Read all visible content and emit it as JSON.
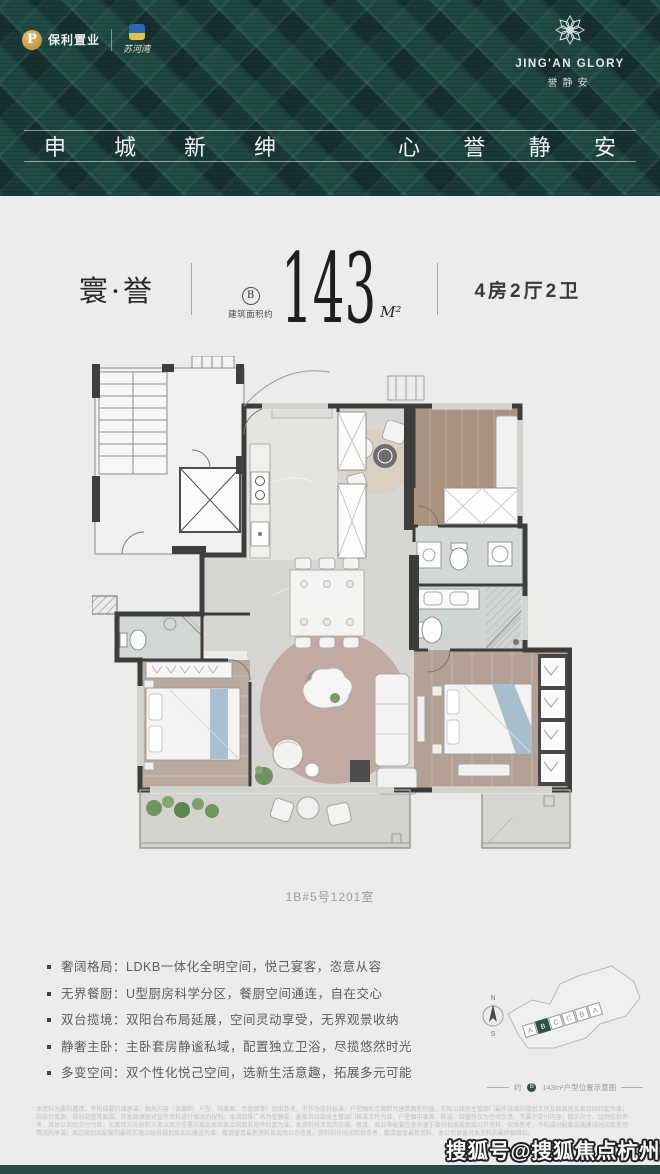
{
  "header": {
    "logo_poly": "保利置业",
    "logo_partner": "苏河湾",
    "brand_en": "JING'AN GLORY",
    "brand_cn": "誉静安",
    "slogan": [
      "申",
      "城",
      "新",
      "绅",
      "心",
      "誉",
      "静",
      "安"
    ]
  },
  "unit": {
    "series": "寰·誉",
    "type_circle": "B",
    "area_prefix": "建筑面积约",
    "area": "143",
    "area_unit": "M²",
    "layout": "4房2厅2卫",
    "room_no": "1B#5号1201室"
  },
  "features": [
    "奢阔格局：LDKB一体化全明空间，悦己宴客，恣意从容",
    "无界餐厨：U型厨房科学分区，餐厨空间通连，自在交心",
    "双台揽境：双阳台布局延展，空间灵动享受，无界观景收纳",
    "静奢主卧：主卧套房静谧私域，配置独立卫浴，尽揽悠然时光",
    "多变空间：双个性化悦己空间，选新生活意趣，拓展多元可能"
  ],
  "siteplan": {
    "compass_n": "N",
    "compass_s": "S",
    "units": [
      "A",
      "B",
      "C",
      "C",
      "B",
      "A"
    ],
    "highlight_fill": "#2f4f48",
    "caption_prefix": "约",
    "caption_circle": "B",
    "caption_text": "143m²户型位置示意图"
  },
  "disclaimer": [
    "本资料为要约邀请，不构成要约或承诺，相关内容（含面积、户型、效果图、示意图等）仅供参考，不作为交付标准；户型图所示面积为建筑面积约值，实际以政府主管部门最终核准的规划文件及商品房买卖合同约定为准；因设计变更、规划调整等原因，开发商保留对宣传资料进行修改的权利。",
    "本项目推广名为誉静安，备案名以政府主管部门核准文件为准；户型图中家具、陈设、绿植等仅为空间示意，不属于交付内容；图示尺寸、比例仅供参考，具体以实际交付为准；买卖双方的权利义务以双方签署的商品房买卖合同及其附件约定为准。",
    "本资料所涉及的交通、教育、商业等配套信息来源于政府相关规划或公开资料，仅供参考，不构成对配套设施建成时间及使用情况的承诺；周边规划及配套的最终实施以政府规划及实际建设为准；敬请留意最新资料及现场公示信息。",
    "资料制作时间仅供参考，敬请留意最新资料，本公司保留对本资料的最终解释权。"
  ],
  "watermark": "搜狐号@搜狐焦点杭州站"
}
